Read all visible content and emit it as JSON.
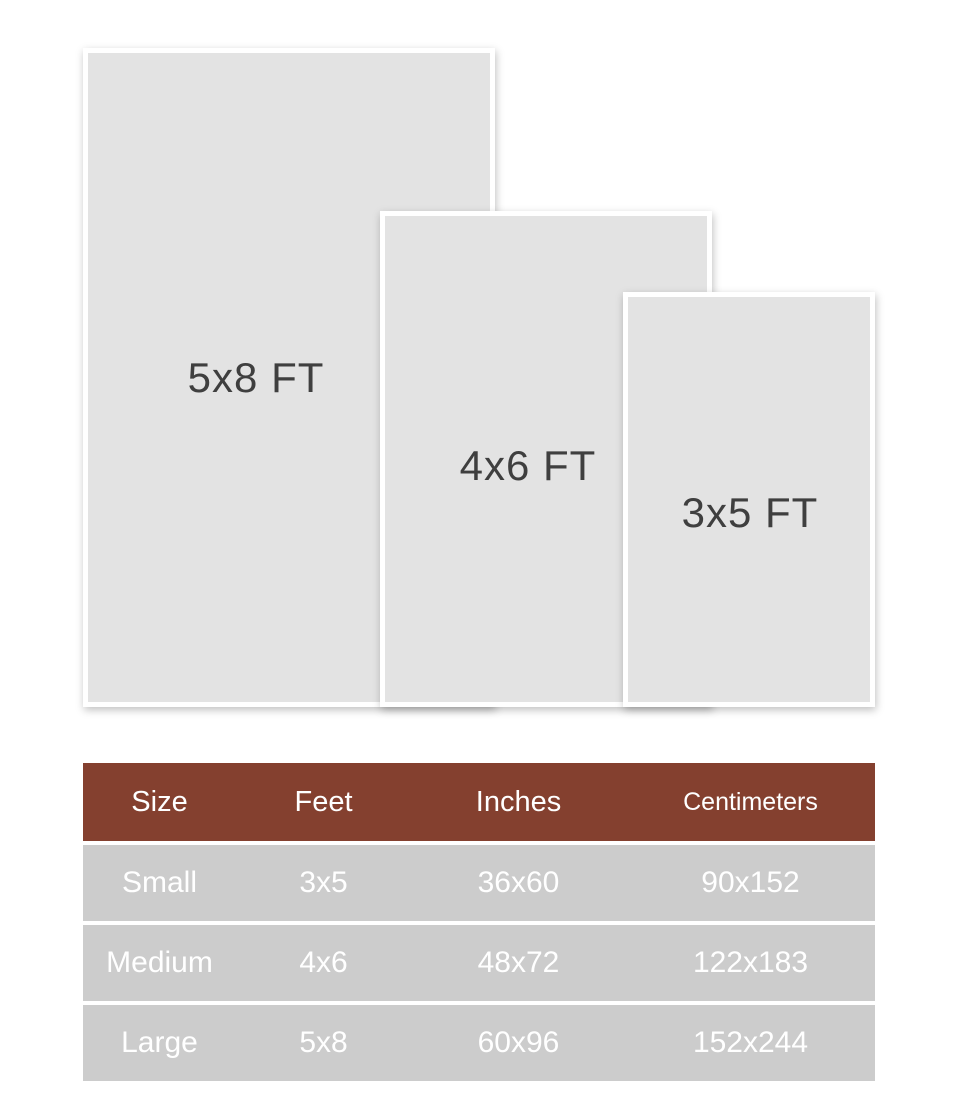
{
  "diagram": {
    "cards": [
      {
        "label": "5x8 FT"
      },
      {
        "label": "4x6 FT"
      },
      {
        "label": "3x5 FT"
      }
    ]
  },
  "size_table": {
    "headers": [
      "Size",
      "Feet",
      "Inches",
      "Centimeters"
    ],
    "rows": [
      [
        "Small",
        "3x5",
        "36x60",
        "90x152"
      ],
      [
        "Medium",
        "4x6",
        "48x72",
        "122x183"
      ],
      [
        "Large",
        "5x8",
        "60x96",
        "152x244"
      ]
    ]
  },
  "colors": {
    "page_bg": "#ffffff",
    "card_bg": "#e3e3e3",
    "card_frame": "#ffffff",
    "label_text": "#3f3f3f",
    "header_bg": "#84402f",
    "header_text": "#ffffff",
    "row_bg": "#cccccc",
    "row_text": "#ffffff"
  }
}
